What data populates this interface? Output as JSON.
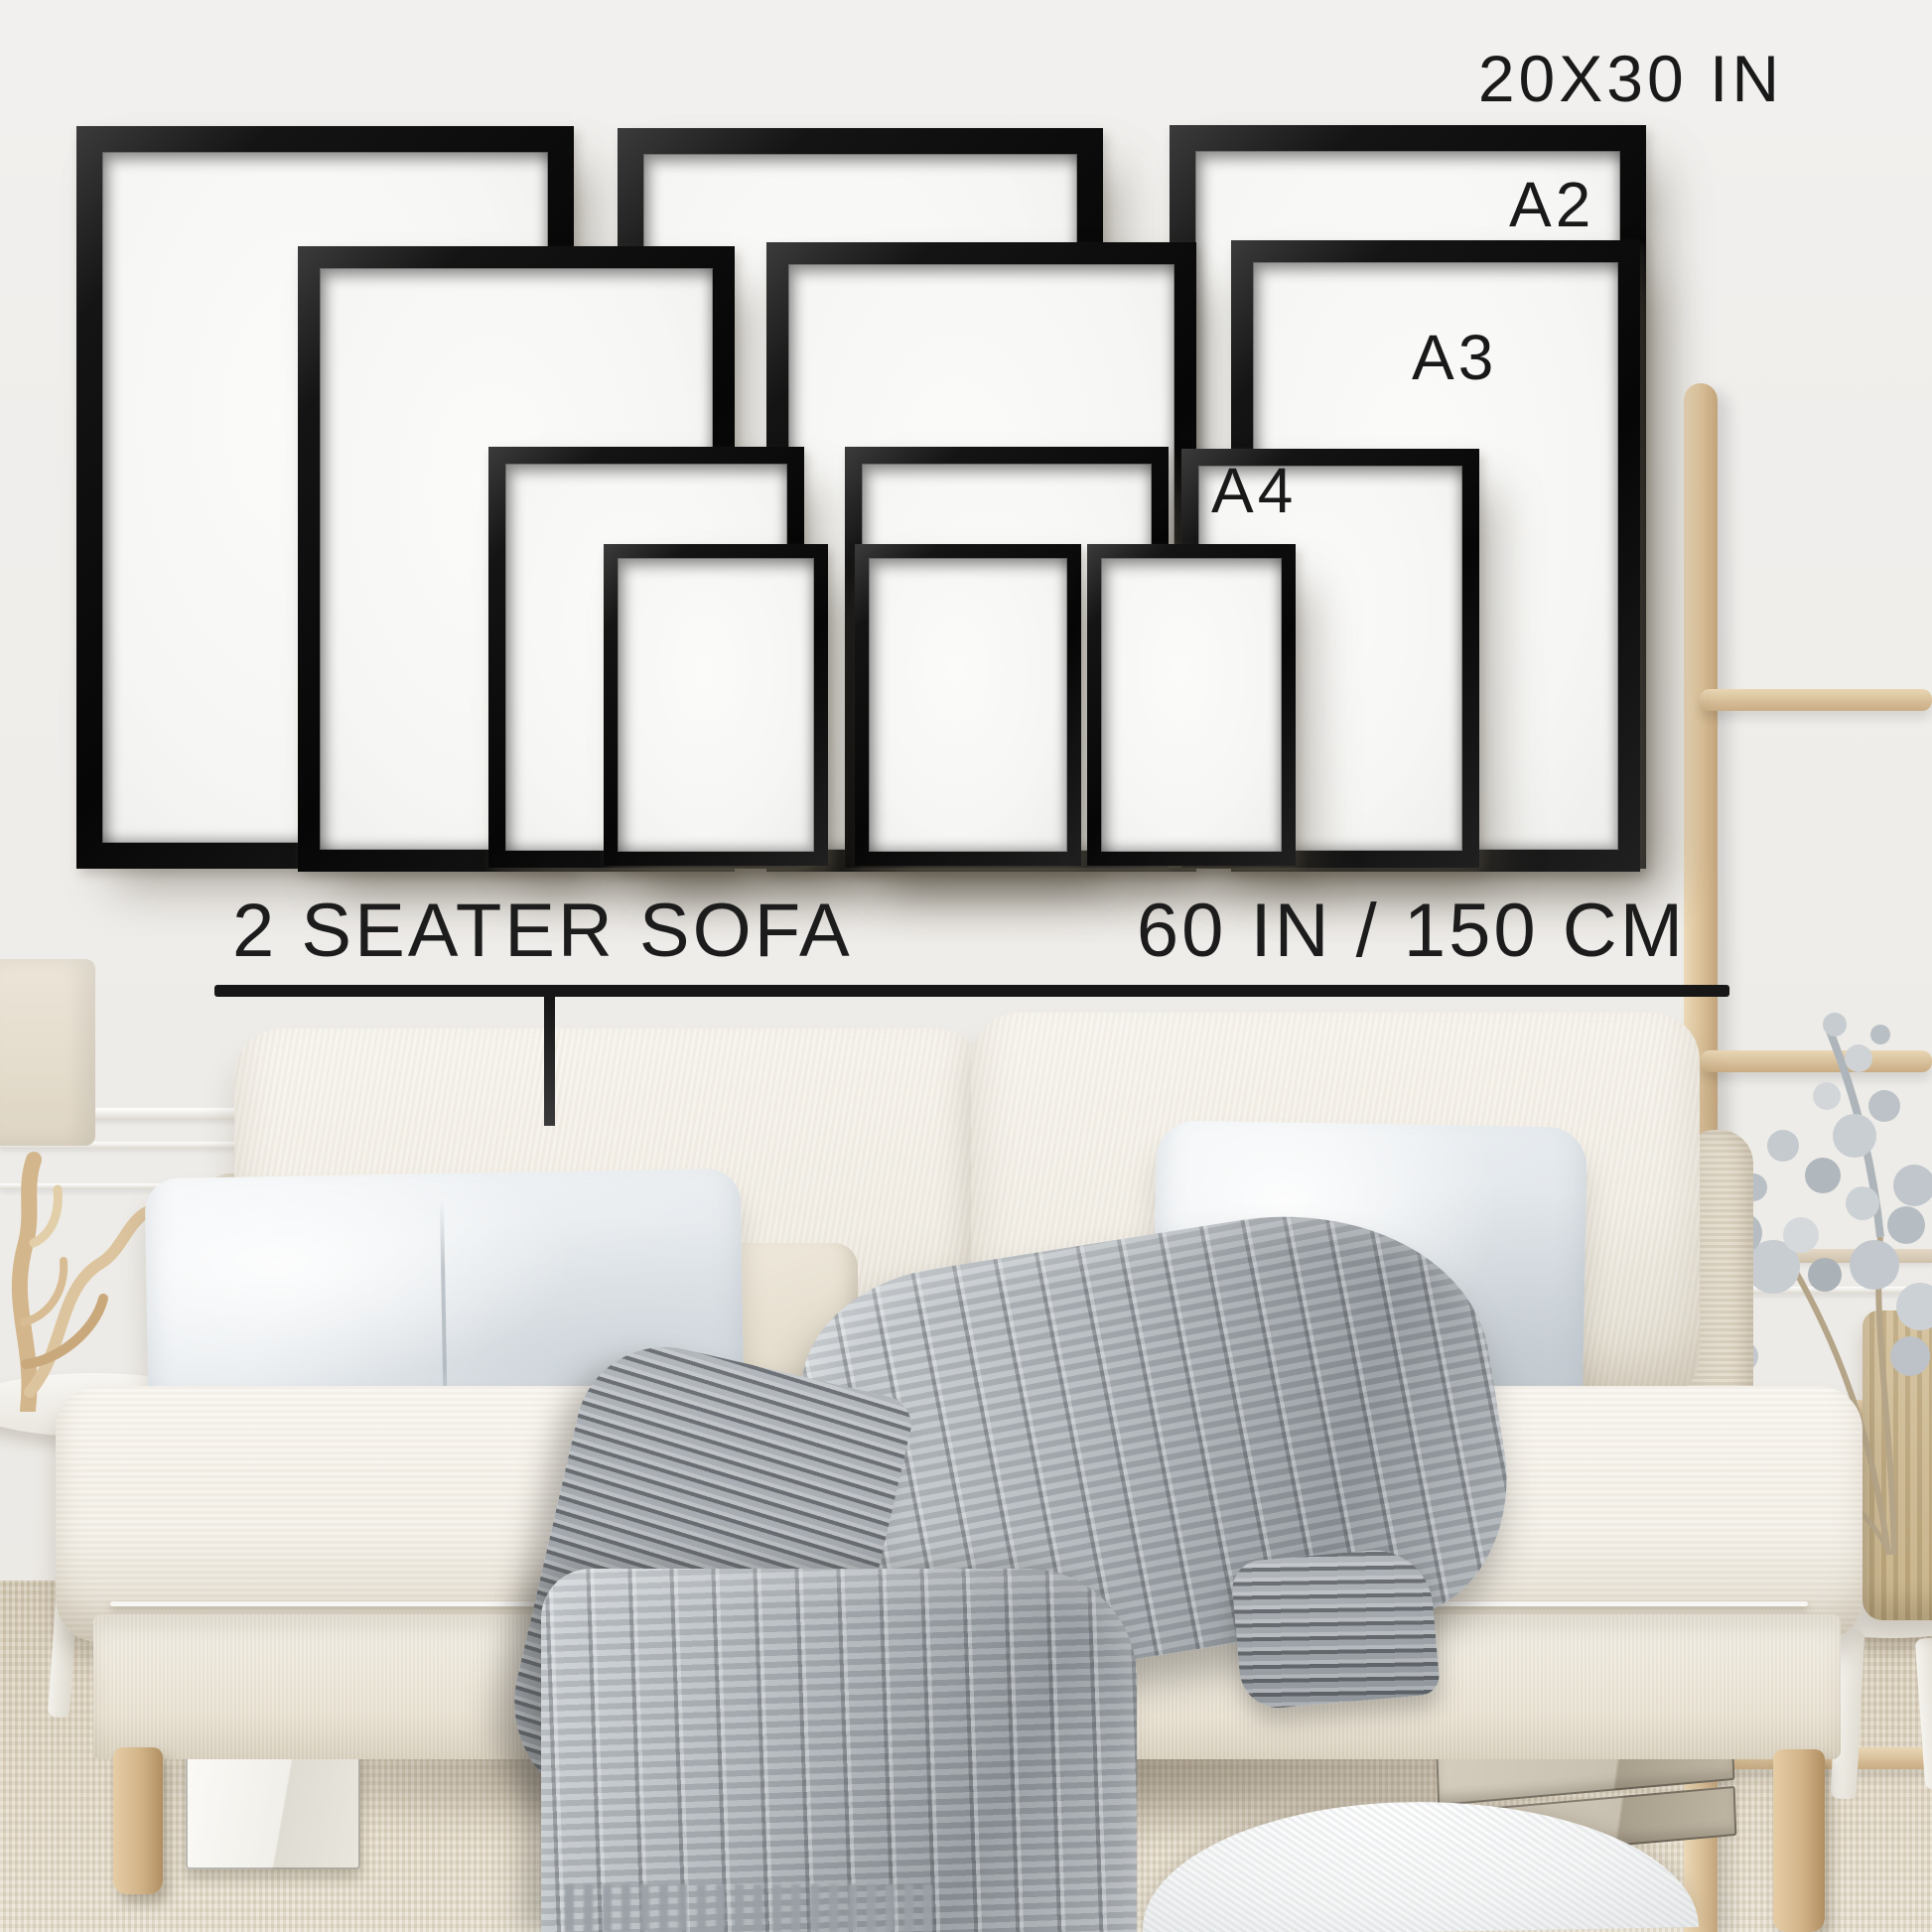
{
  "annotations": {
    "largest_size": "20X30 IN",
    "size_a2": "A2",
    "size_a3": "A3",
    "size_a4": "A4"
  },
  "scale_bar": {
    "label": "2 SEATER SOFA",
    "measurement": "60 IN / 150 CM"
  },
  "frames": [
    {
      "size": "20X30 IN",
      "column": "left"
    },
    {
      "size": "20X30 IN",
      "column": "middle"
    },
    {
      "size": "20X30 IN",
      "column": "right"
    },
    {
      "size": "A2",
      "column": "left"
    },
    {
      "size": "A2",
      "column": "middle"
    },
    {
      "size": "A2",
      "column": "right"
    },
    {
      "size": "A3",
      "column": "left"
    },
    {
      "size": "A3",
      "column": "middle"
    },
    {
      "size": "A3",
      "column": "right"
    },
    {
      "size": "A4",
      "column": "left"
    },
    {
      "size": "A4",
      "column": "middle"
    },
    {
      "size": "A4",
      "column": "right"
    }
  ],
  "colors": {
    "wall": "#f0eeeb",
    "frame": "#111111",
    "frame_mat": "#f9f9f7",
    "text": "#1a1a1a",
    "sofa_fabric": "#f4f0e8",
    "pillow_gray": "#e4e8ec",
    "blanket_gray": "#a8aeb3",
    "wood": "#ddc5a0",
    "carpet": "#ded4c2",
    "cardboard": "#cdc5b6"
  }
}
